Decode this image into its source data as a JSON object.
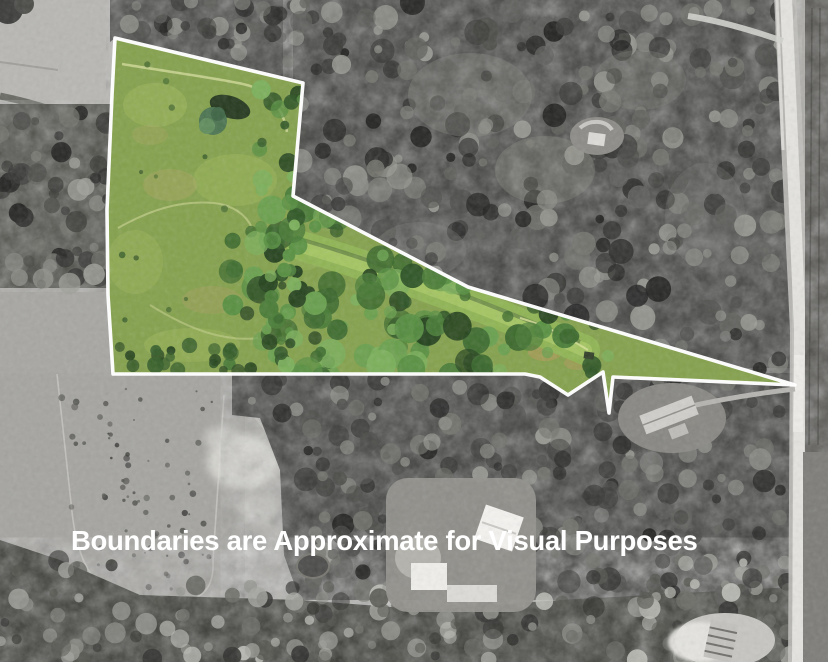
{
  "map": {
    "disclaimer": "Boundaries are Approximate for Visual Purposes",
    "boundary_points": "115,38 303,83 293,196 468,287 795,385 613,377 609,413 603,372 568,395 540,377 525,374 113,374 108,295 107,210 112,95",
    "colors": {
      "boundary_stroke": "#ffffff",
      "disclaimer_text": "#ffffff",
      "field_green": "#84a14c",
      "meadow_green": "#8fb453",
      "tree_green": "#33582a",
      "photo_gray": "#b3b2ae"
    }
  }
}
